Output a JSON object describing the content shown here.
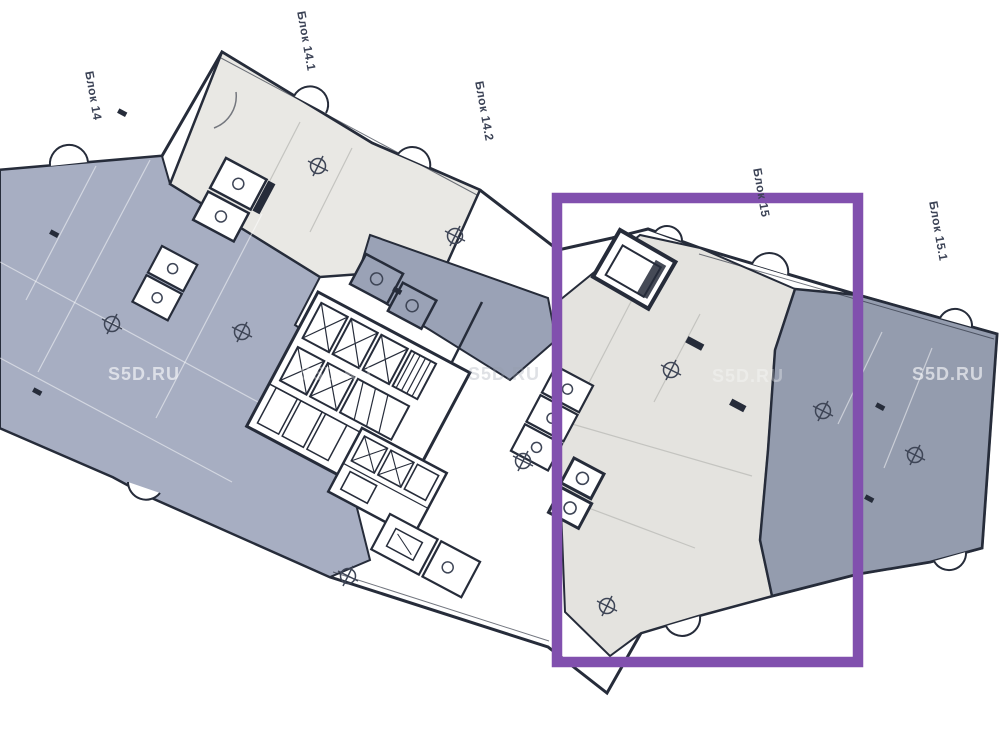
{
  "canvas": {
    "width": 1000,
    "height": 750
  },
  "plan": {
    "type": "architectural-floor-plan",
    "block_labels": [
      {
        "id": "block-14",
        "text": "Блок 14"
      },
      {
        "id": "block-14-1",
        "text": "Блок 14.1"
      },
      {
        "id": "block-14-2",
        "text": "Блок 14.2"
      },
      {
        "id": "block-15",
        "text": "Блок 15"
      },
      {
        "id": "block-15-1",
        "text": "Блок 15.1"
      }
    ],
    "highlight": {
      "shape": "rectangle",
      "target": "Блок 15",
      "color": "#8150ae"
    }
  },
  "watermark": {
    "text": "S5D.RU"
  },
  "colors": {
    "line": "#262c3a",
    "left_wing": "#a7aec2",
    "mid_wing": "#9aa2b6",
    "right_wing": "#949cae",
    "light_block": "#e9e8e4",
    "light_block_15": "#e4e3df",
    "highlight": "#8150ae",
    "label_text": "#3c4356",
    "marker": "#3e4556"
  }
}
